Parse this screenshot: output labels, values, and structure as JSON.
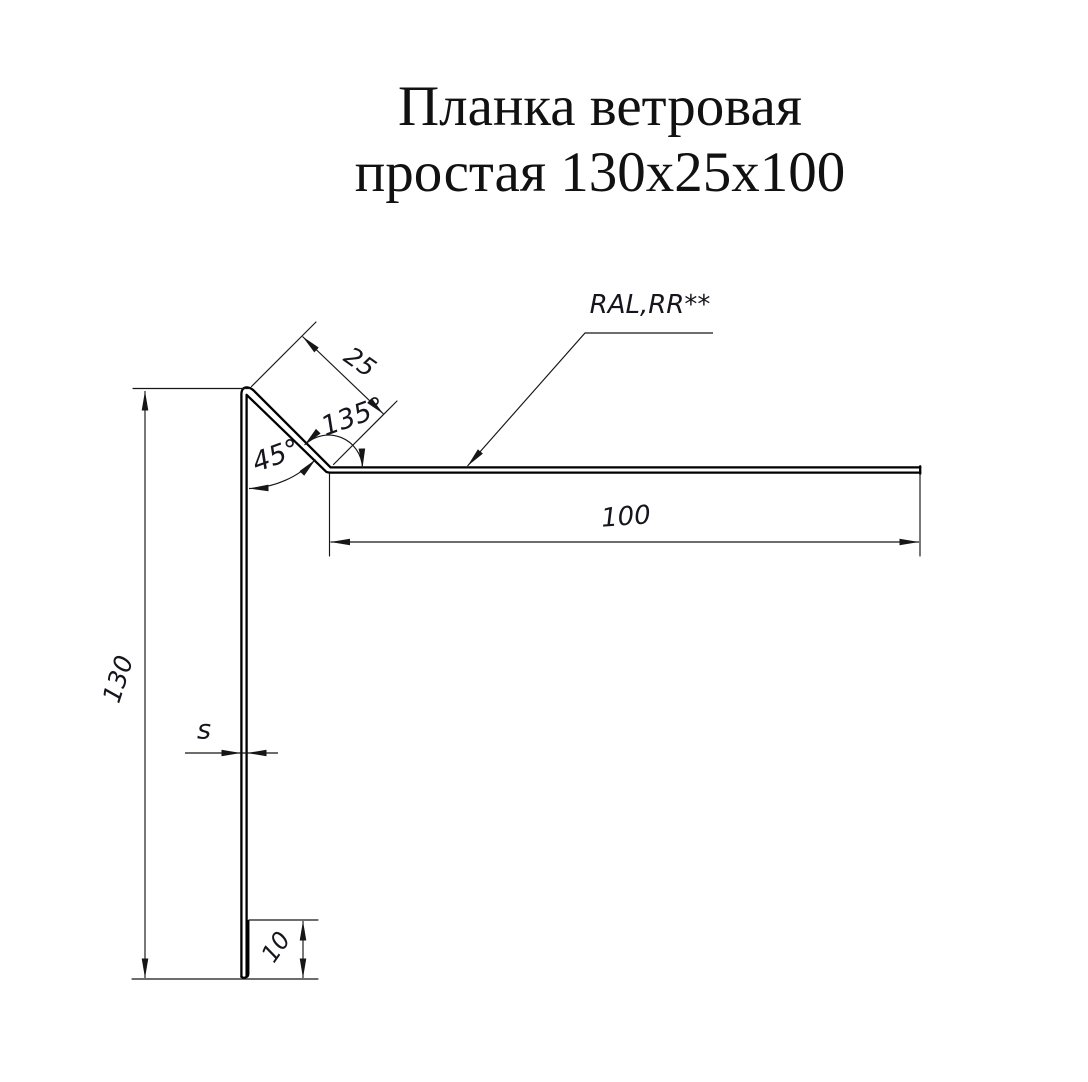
{
  "title": {
    "line1": "Планка ветровая",
    "line2": "простая 130x25x100"
  },
  "dimensions": {
    "height": "130",
    "flange": "25",
    "top_angle": "45°",
    "bottom_angle": "135°",
    "width": "100",
    "thickness": "s",
    "hem": "10"
  },
  "annotations": {
    "coating": "RAL,RR**"
  },
  "colors": {
    "background": "#ffffff",
    "profile_line": "#000000",
    "dimension_line": "#161616",
    "text": "#15151d"
  }
}
